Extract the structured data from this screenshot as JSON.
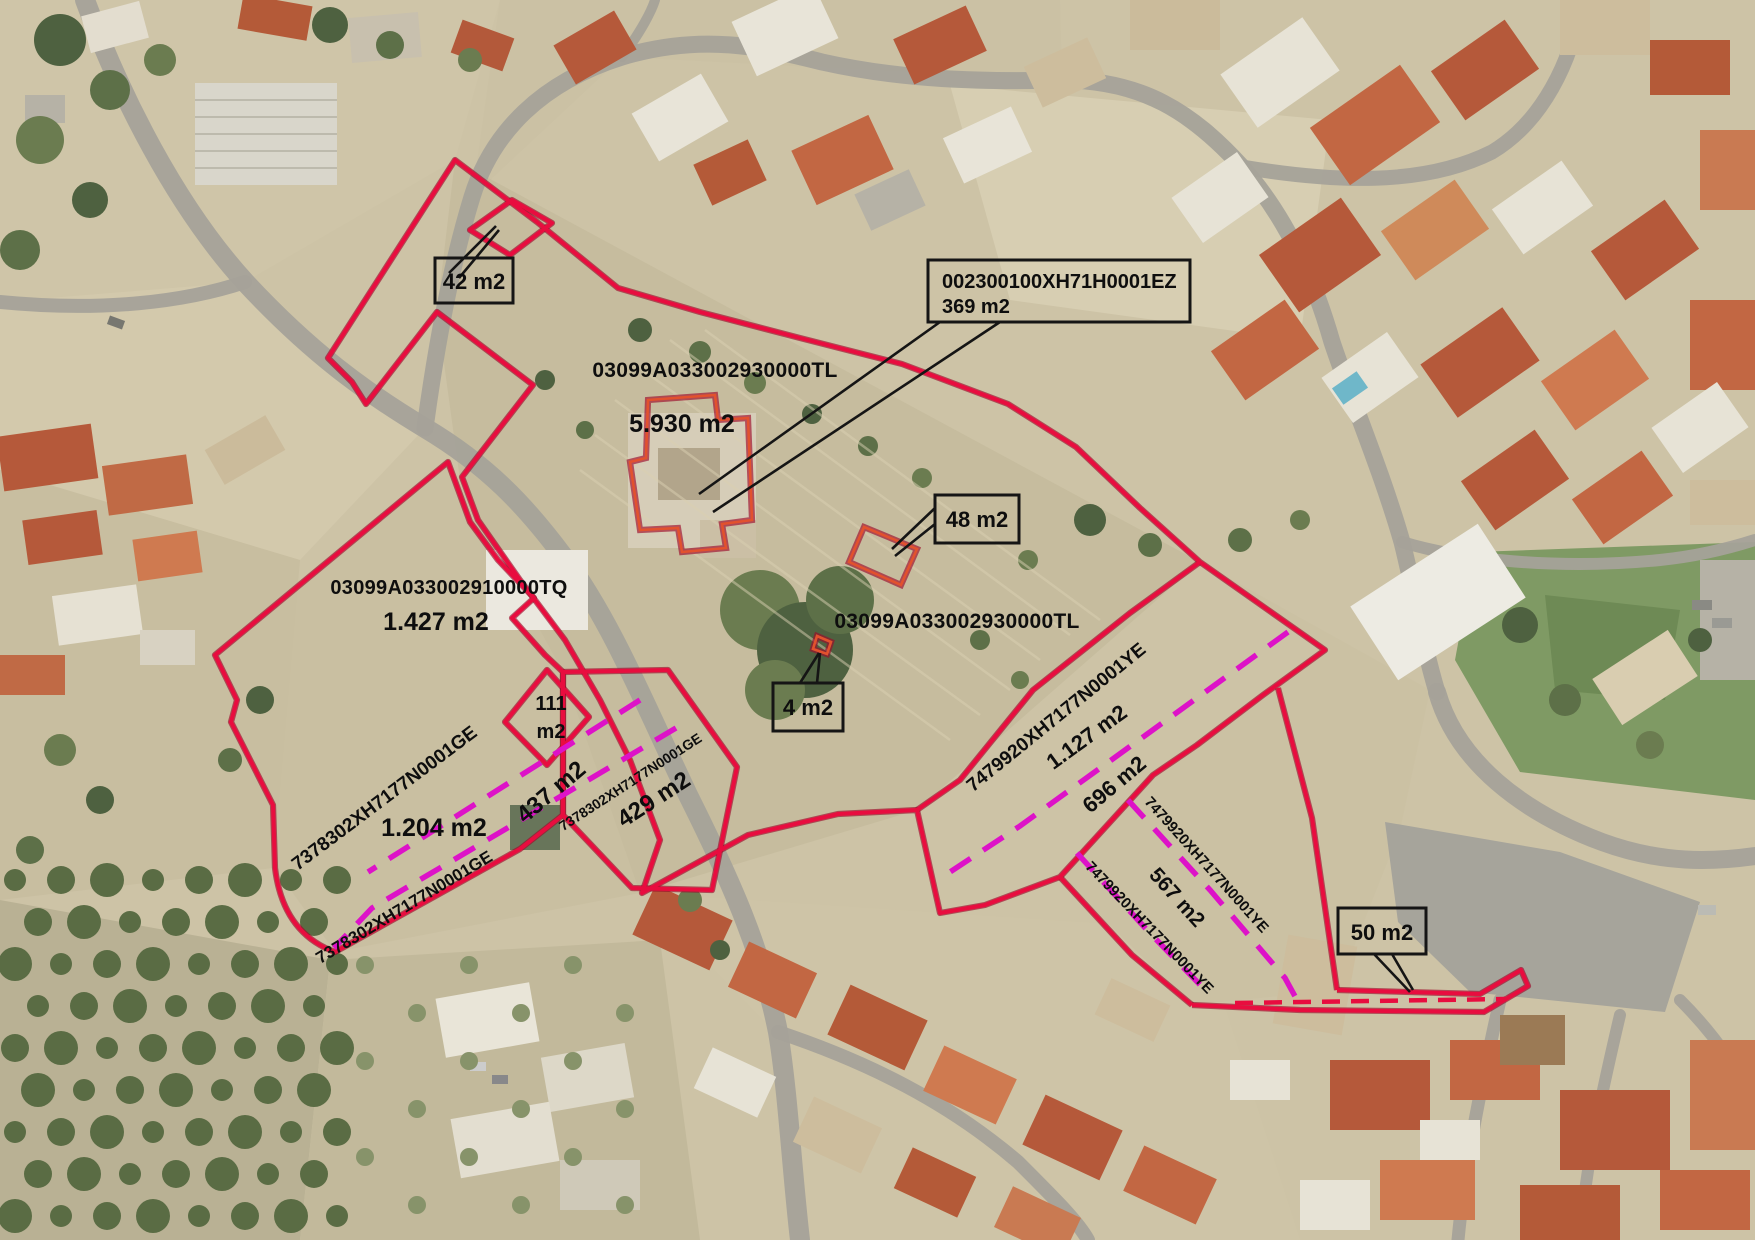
{
  "map": {
    "type": "aerial-cadastral-overlay",
    "overlay": {
      "refs": {
        "tl": "03099A033002930000TL",
        "tq": "03099A033002910000TQ",
        "ge": "7378302XH7177N0001GE",
        "ye": "7479920XH7177N0001YE",
        "ez": "002300100XH71H0001EZ"
      },
      "areas": {
        "tl": "5.930 m2",
        "tq": "1.427 m2",
        "ge_main": "1.204 m2",
        "ge_437": "437 m2",
        "ge_429": "429 m2",
        "ge_111_line1": "111",
        "ge_111_line2": "m2",
        "ye_1127": "1.127 m2",
        "ye_696": "696 m2",
        "ye_567": "567 m2",
        "ez": "369 m2"
      },
      "callouts": {
        "c42": "42 m2",
        "c48": "48 m2",
        "c4": "4 m2",
        "c50": "50 m2"
      },
      "colors": {
        "parcel_line": "#e80d3f",
        "divider_dash": "#dd12c8",
        "callout_line": "#151515"
      }
    }
  }
}
